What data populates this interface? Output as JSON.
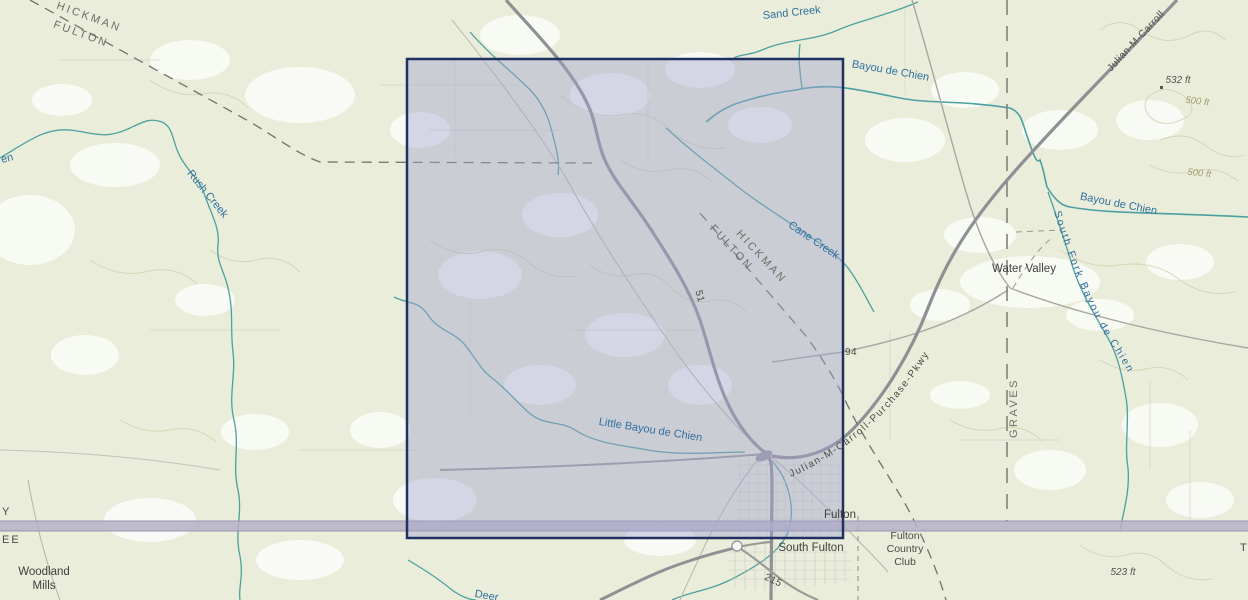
{
  "map": {
    "colors": {
      "background": "#e9edda",
      "water": "#4da0a0",
      "water_label": "#31709f",
      "road_major": "#8f9094",
      "state_line_band": "#b5b0c6",
      "selection_fill": "#a2a2d0",
      "selection_border": "#1e3162"
    },
    "selection": {
      "x": 407,
      "y": 59,
      "width": 436,
      "height": 479
    },
    "curved_labels": {
      "south_fork": {
        "text": "South Fork Bayou de Chien"
      },
      "purchase_pkwy": {
        "text": "Julian-M-Carroll-Purchase-Pkwy"
      }
    },
    "labels": [
      {
        "id": "hickman-nw",
        "text": "HICKMAN",
        "x": 88,
        "y": 20,
        "rot": 20,
        "cls": "county"
      },
      {
        "id": "fulton-nw",
        "text": "FULTON",
        "x": 80,
        "y": 37,
        "rot": 20,
        "cls": "county"
      },
      {
        "id": "hickman-mid",
        "text": "HICKMAN",
        "x": 759,
        "y": 259,
        "rot": 47,
        "cls": "county"
      },
      {
        "id": "fulton-mid",
        "text": "FULTON",
        "x": 729,
        "y": 250,
        "rot": 47,
        "cls": "county"
      },
      {
        "id": "graves",
        "text": "GRAVES",
        "x": 1017,
        "y": 408,
        "rot": -90,
        "cls": "county"
      },
      {
        "id": "water-valley",
        "text": "Water Valley",
        "x": 1024,
        "y": 272,
        "cls": "town"
      },
      {
        "id": "fulton-city",
        "text": "Fulton",
        "x": 840,
        "y": 518,
        "cls": "town"
      },
      {
        "id": "south-fulton",
        "text": "South Fulton",
        "x": 811,
        "y": 551,
        "cls": "town"
      },
      {
        "id": "fulton-country-club-1",
        "text": "Fulton",
        "x": 905,
        "y": 539,
        "cls": "town-sm"
      },
      {
        "id": "fulton-country-club-2",
        "text": "Country",
        "x": 905,
        "y": 552,
        "cls": "town-sm"
      },
      {
        "id": "fulton-country-club-3",
        "text": "Club",
        "x": 905,
        "y": 565,
        "cls": "town-sm"
      },
      {
        "id": "woodland-mills-1",
        "text": "Woodland",
        "x": 44,
        "y": 575,
        "cls": "town"
      },
      {
        "id": "woodland-mills-2",
        "text": "Mills",
        "x": 44,
        "y": 589,
        "cls": "town"
      },
      {
        "id": "sand-creek",
        "text": "Sand Creek",
        "x": 792,
        "y": 16,
        "rot": -6,
        "cls": "creek"
      },
      {
        "id": "bayou-de-chien-w",
        "text": "Bayou de Chien",
        "x": 890,
        "y": 74,
        "rot": 10,
        "cls": "creek"
      },
      {
        "id": "bayou-de-chien-e",
        "text": "Bayou de Chien",
        "x": 1118,
        "y": 207,
        "rot": 11,
        "cls": "creek"
      },
      {
        "id": "rush-creek",
        "text": "Rush Creek",
        "x": 205,
        "y": 196,
        "rot": 51,
        "cls": "creek"
      },
      {
        "id": "chien-partial",
        "text": "en",
        "x": 2,
        "y": 163,
        "rot": -14,
        "cls": "creek",
        "anchor": "start"
      },
      {
        "id": "cane-creek",
        "text": "Cane Creek",
        "x": 812,
        "y": 243,
        "rot": 34,
        "cls": "creek"
      },
      {
        "id": "little-bayou-de-chien",
        "text": "Little Bayou de Chien",
        "x": 650,
        "y": 433,
        "rot": 9,
        "cls": "creek"
      },
      {
        "id": "deer",
        "text": "Deer",
        "x": 486,
        "y": 599,
        "rot": 10,
        "cls": "creek"
      },
      {
        "id": "julian-m-carroll-top",
        "text": "Julian-M-Carroll",
        "x": 1138,
        "y": 43,
        "rot": -47,
        "cls": "road"
      },
      {
        "id": "route-51",
        "text": "51",
        "x": 697,
        "y": 297,
        "rot": 75,
        "cls": "road"
      },
      {
        "id": "route-94",
        "text": "94",
        "x": 851,
        "y": 355,
        "cls": "road"
      },
      {
        "id": "route-215",
        "text": "215",
        "x": 772,
        "y": 583,
        "rot": 25,
        "cls": "road"
      },
      {
        "id": "elev-532",
        "text": "532 ft",
        "x": 1178,
        "y": 83,
        "cls": "elev"
      },
      {
        "id": "contour-500-a",
        "text": "500 ft",
        "x": 1197,
        "y": 104,
        "rot": 6,
        "cls": "contour"
      },
      {
        "id": "contour-500-b",
        "text": "500 ft",
        "x": 1199,
        "y": 176,
        "rot": 6,
        "cls": "contour"
      },
      {
        "id": "elev-523",
        "text": "523 ft",
        "x": 1123,
        "y": 575,
        "cls": "elev"
      },
      {
        "id": "state-ky-partial",
        "text": "Y",
        "x": 2,
        "y": 515,
        "cls": "state",
        "anchor": "start"
      },
      {
        "id": "state-tn-partial",
        "text": "EE",
        "x": 2,
        "y": 543,
        "cls": "state",
        "anchor": "start"
      },
      {
        "id": "state-tn-right",
        "text": "T",
        "x": 1240,
        "y": 551,
        "cls": "state",
        "anchor": "start"
      }
    ]
  }
}
